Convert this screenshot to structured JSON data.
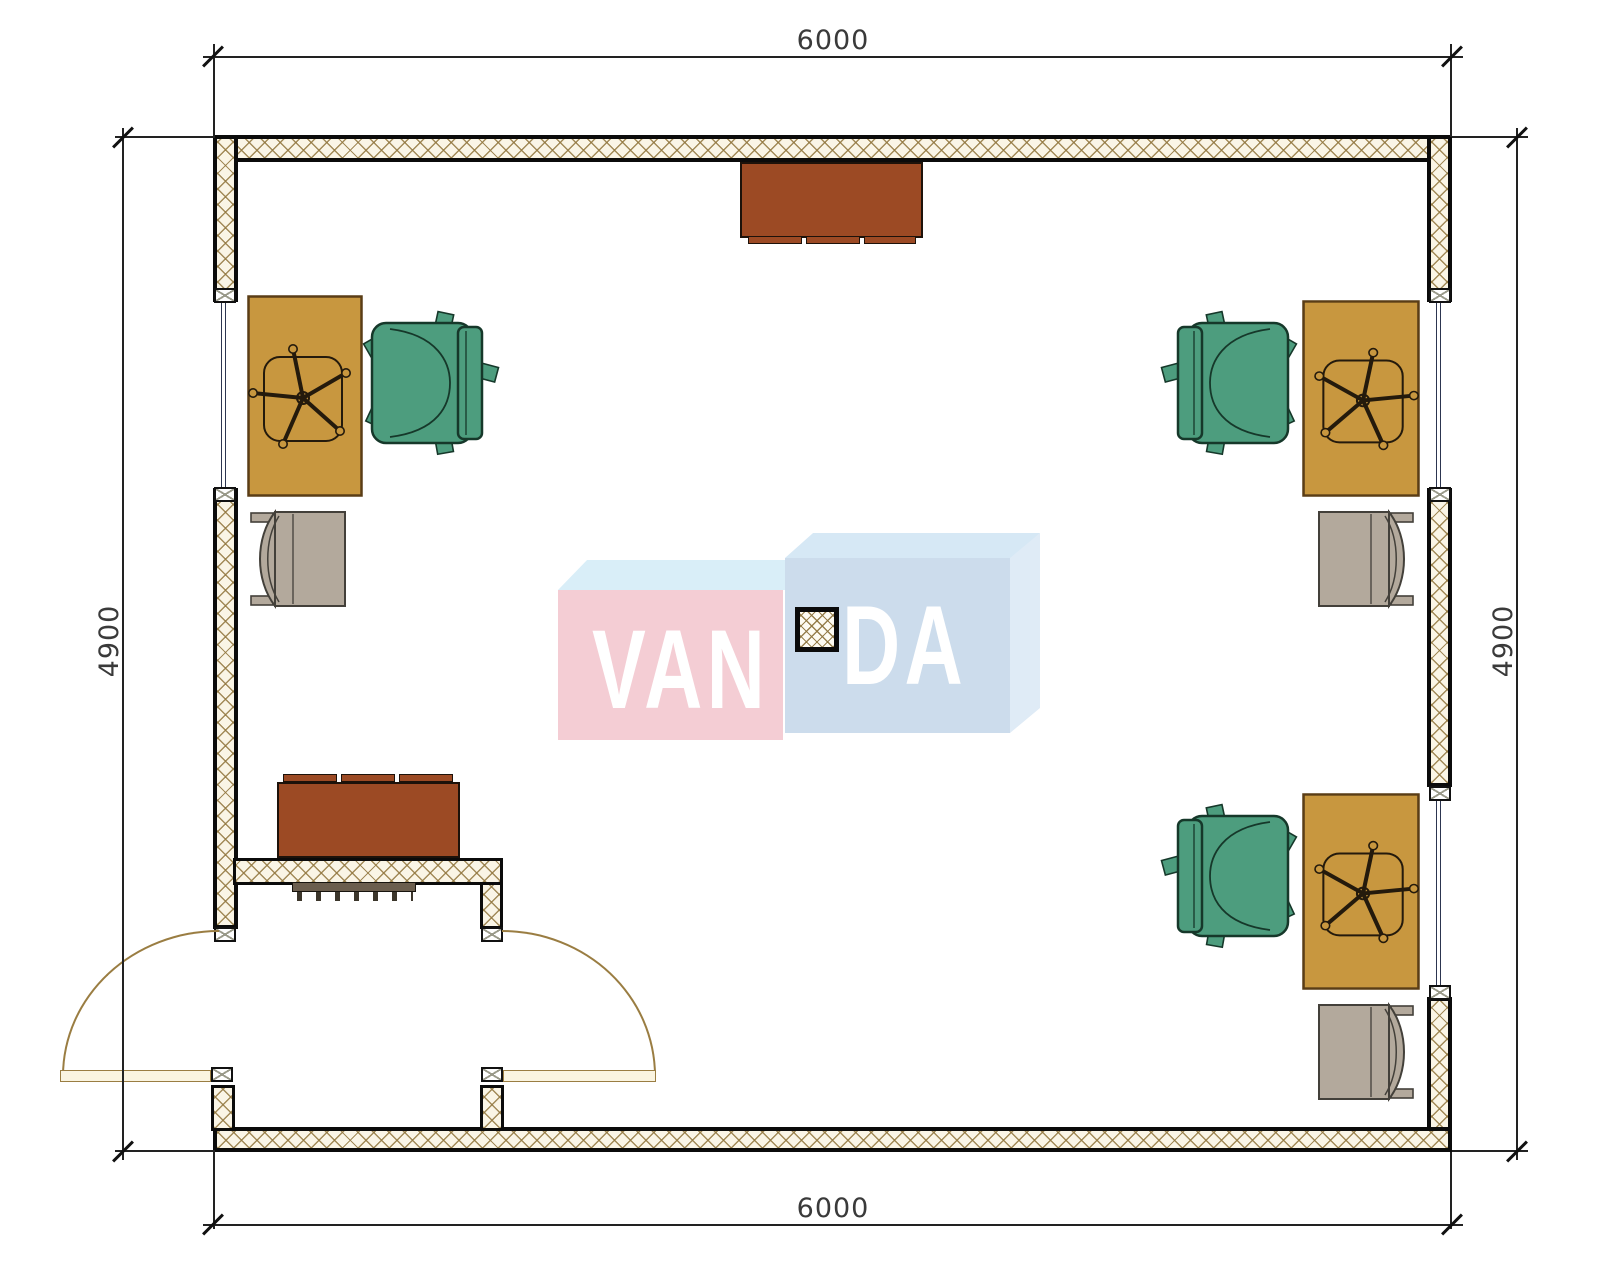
{
  "dimensions": {
    "top": "6000",
    "bottom": "6000",
    "left": "4900",
    "right": "4900",
    "unit_note": "mm"
  },
  "watermark": {
    "brand": "VANDA",
    "left_part": "VAN",
    "right_part": "DA"
  },
  "colors": {
    "wall_hatch_bg": "#faf5e6",
    "desk": "#c8973f",
    "chair_green": "#4d9d7e",
    "chair_green_line": "#16382a",
    "armchair_gray": "#b3a99c",
    "armchair_line": "#43403a",
    "cabinet": "#9c4a24",
    "radiator": "#6b5e4e",
    "door_arc": "#9a7d42",
    "door_leaf_fill": "#faf4e0",
    "logo_pink": "#f4cdd4",
    "logo_top_left": "#d9eef8",
    "logo_blue_front": "#ccdcec",
    "logo_blue_top": "#d6e8f5",
    "logo_blue_side": "#dfebf6",
    "logo_text": "#ffffff"
  },
  "legend": {
    "room": "office 6000 x 4900",
    "items": [
      {
        "name": "desk",
        "count": 3
      },
      {
        "name": "swivel-chair",
        "count": 3
      },
      {
        "name": "armchair",
        "count": 3
      },
      {
        "name": "cabinet",
        "count": 2
      },
      {
        "name": "radiator",
        "count": 1
      },
      {
        "name": "column",
        "count": 1
      },
      {
        "name": "window",
        "count": 3
      },
      {
        "name": "double-entry-door",
        "count": 1
      }
    ]
  }
}
